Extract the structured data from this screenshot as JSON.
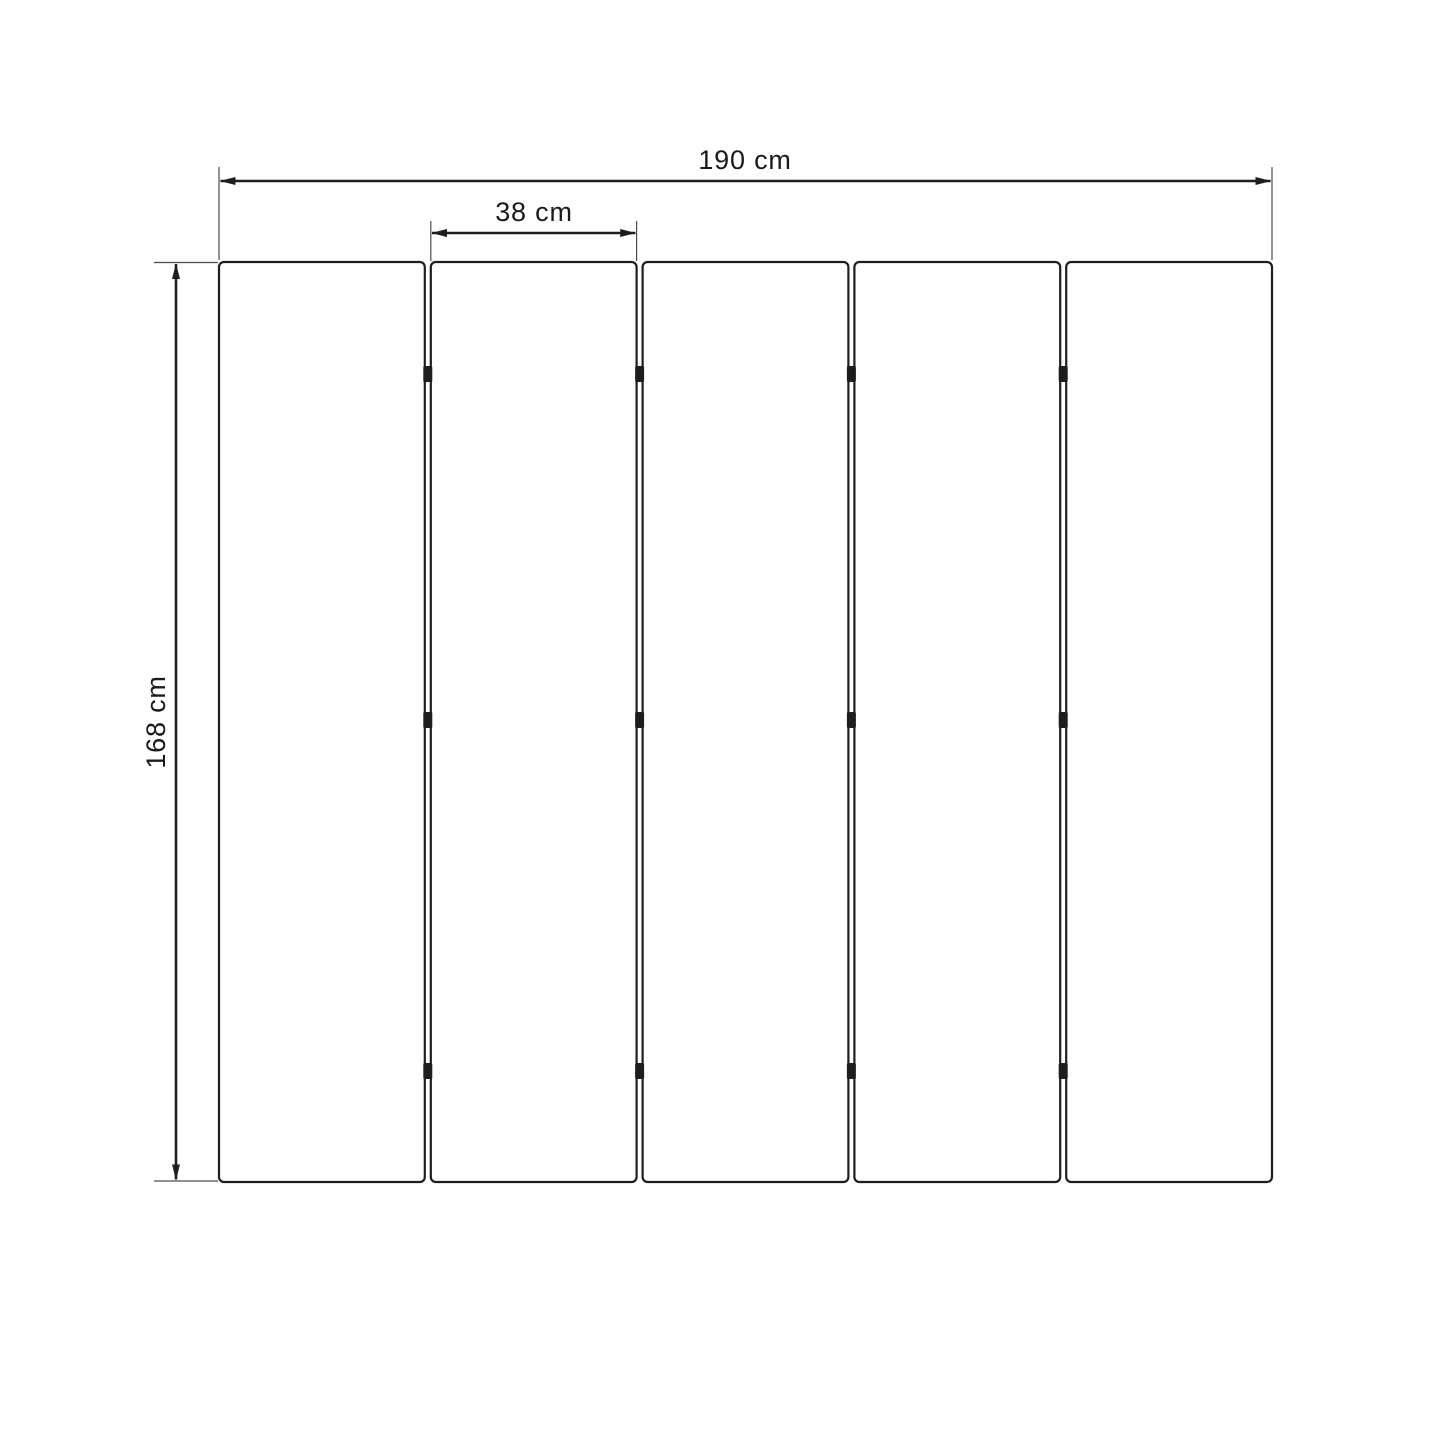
{
  "diagram": {
    "type": "dimension-drawing",
    "subject": "five hinged vertical panels (room divider / slatted screen) with dimension arrows",
    "labels": {
      "total_width": "190 cm",
      "single_panel_width": "38 cm",
      "height": "168 cm"
    },
    "values_cm": {
      "total_width": 190,
      "single_panel_width": 38,
      "height": 168
    },
    "panels": {
      "count": 5,
      "gaps": 4,
      "hinge_marks_per_gap": 3
    },
    "colors": {
      "background": "#ffffff",
      "line": "#1e1e1e",
      "extension_line": "#4a4a4a",
      "text": "#1a1a1a"
    }
  }
}
